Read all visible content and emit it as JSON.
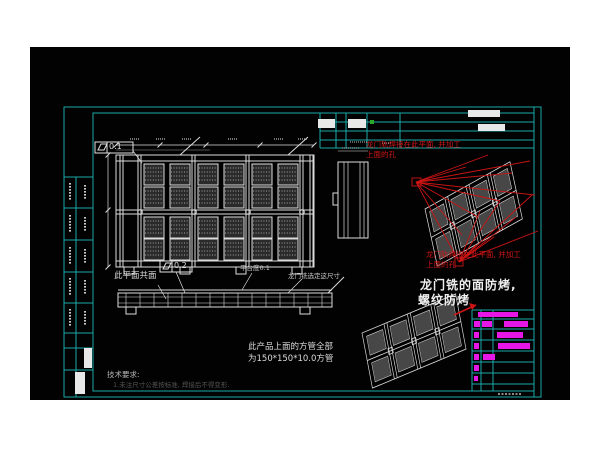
{
  "drawing": {
    "annotations": {
      "coplanar": "此平面共面",
      "platform_flatness": "平台度0.1",
      "gantry_mill_dimension": "龙门铣选定这尺寸",
      "square_tube_line1": "此产品上面的方管全部",
      "square_tube_line2": "为150*150*10.0方管",
      "gantry_face_line1": "龙门铣的面防烤,",
      "gantry_face_line2": "螺纹防烤",
      "red_note_upper_line1": "龙门轨焊接在此平面, 并加工",
      "red_note_upper_line2": "上面的孔",
      "red_note_lower_line1": "龙门轨焊接在此平面, 并加工",
      "red_note_lower_line2": "上面的孔",
      "tech_requirements_title": "技术要求:",
      "tech_requirements_line1": "1.未注尺寸公差按标准, 焊接后不得变形."
    },
    "gdt": {
      "flatness_a": "0.1",
      "flatness_b": "0.2"
    },
    "colors": {
      "frame": "#1ba8a8",
      "lines": "#dcdcdc",
      "highlight_red": "#cc1414",
      "bom_magenta": "#e616e6",
      "background": "#020202"
    }
  }
}
